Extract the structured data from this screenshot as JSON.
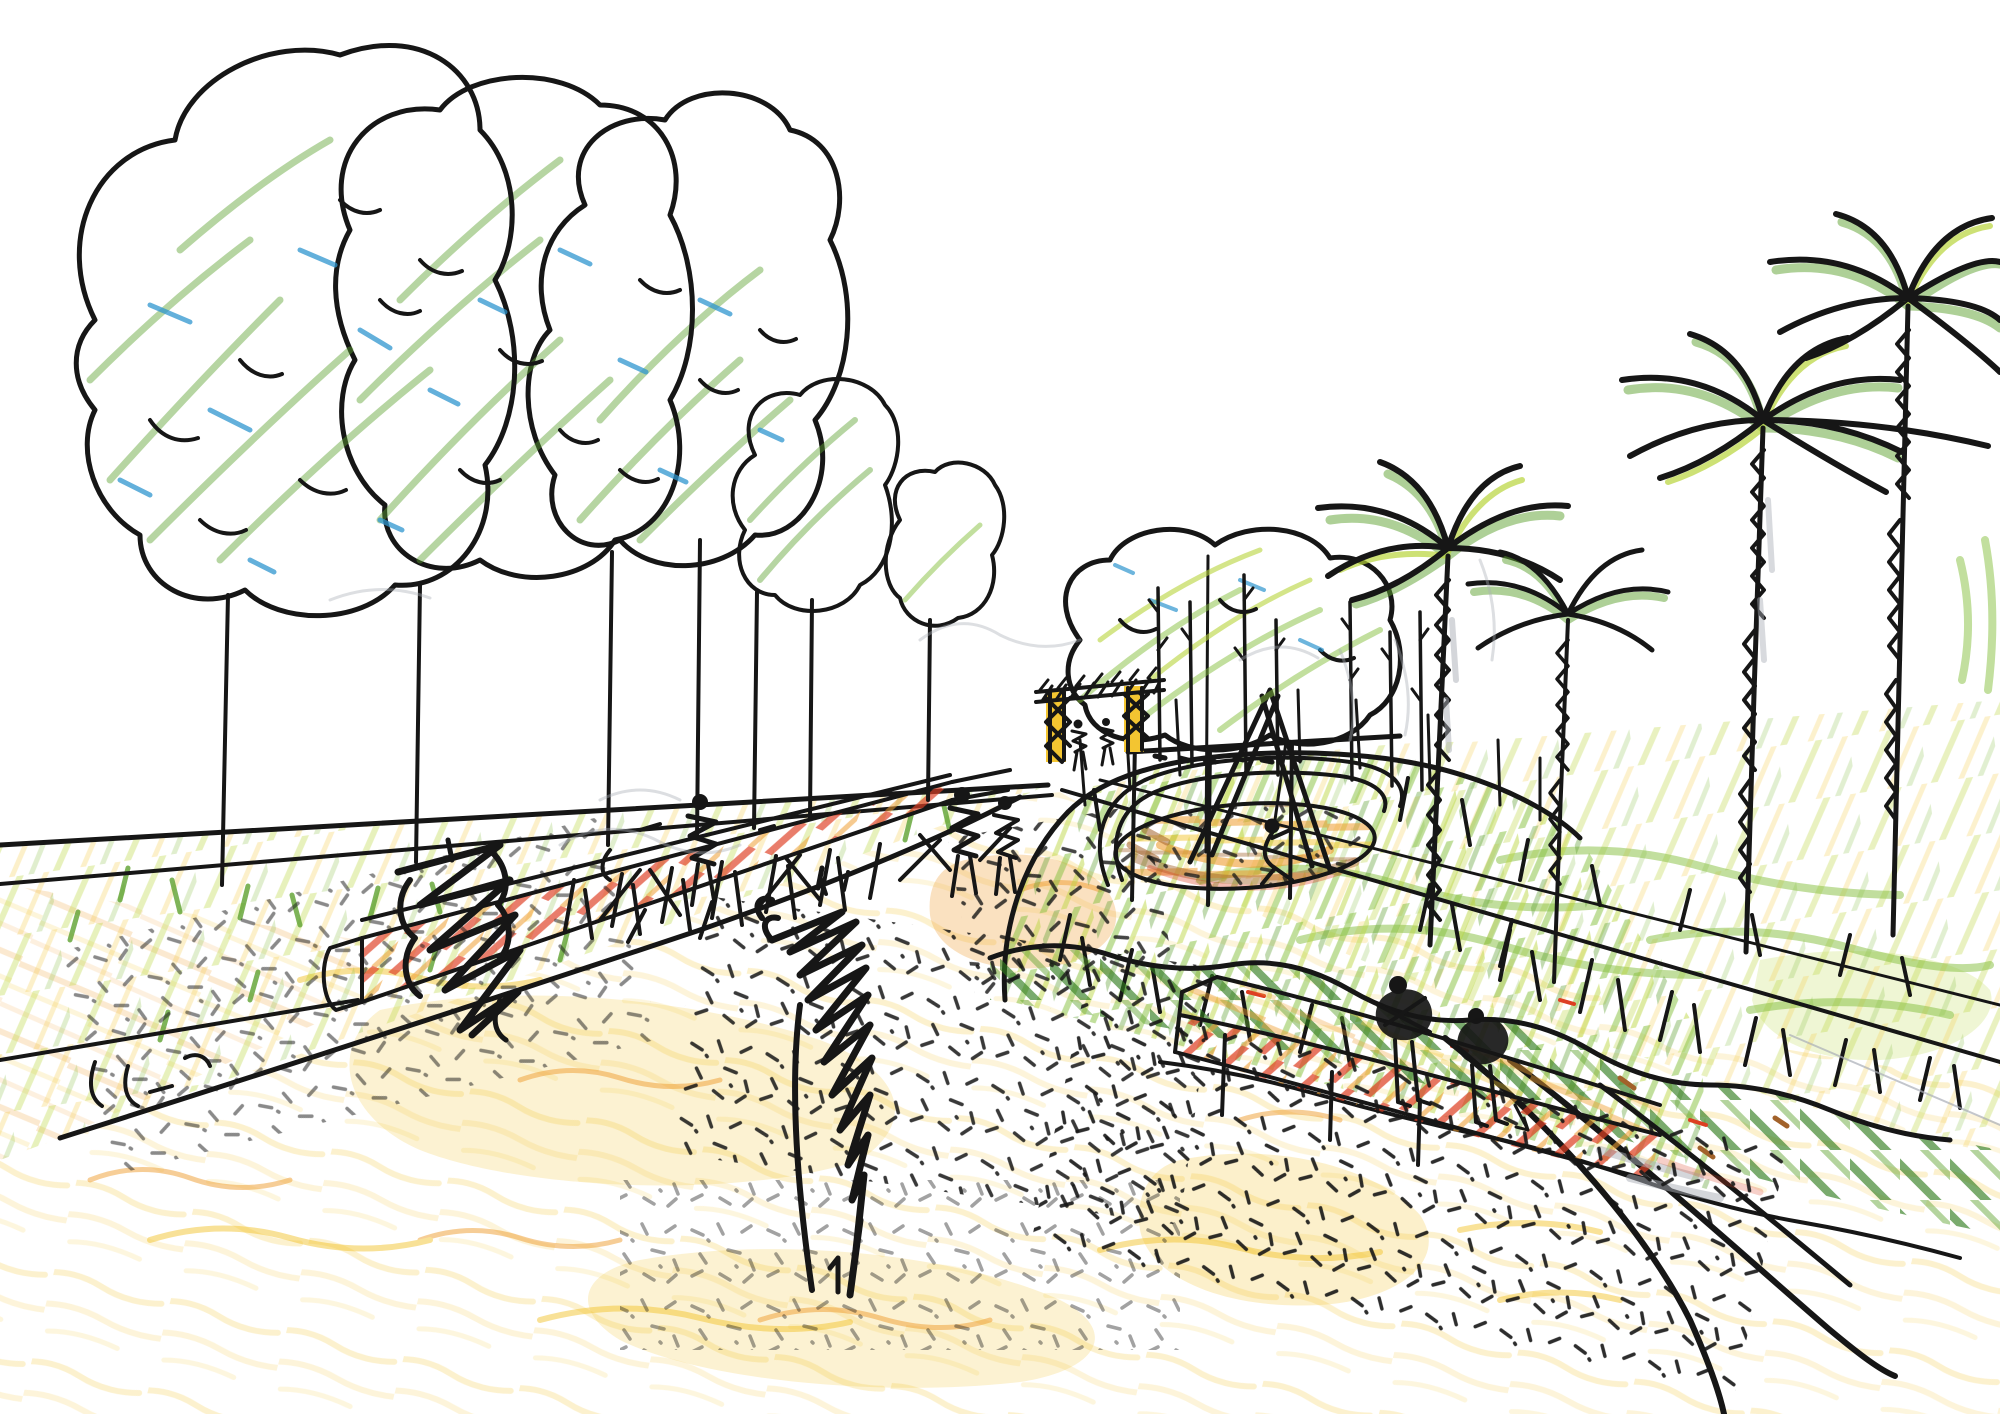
{
  "meta": {
    "title": "Hand-drawn landscape design perspective sketch",
    "medium": "black ink pen with colored pencil and crayon on white paper",
    "view": "one-point perspective of a park promenade"
  },
  "palette": {
    "paper": "#ffffff",
    "ink": "#161616",
    "green": "#5ea130",
    "green-light": "#85bf3e",
    "green-dark": "#2f7a1c",
    "yellow-green": "#b8d43a",
    "yellow": "#f3c531",
    "yellow-pale": "#f9e49a",
    "orange": "#ef9d30",
    "red": "#dd3f22",
    "brown": "#a2622b",
    "blue": "#2f96cf",
    "gray": "#a9aeb6"
  },
  "scene": {
    "elements": [
      {
        "name": "deciduous-tree-group-left",
        "description": "Four overlapping cloud-shaped canopies outlined in ink, filled with diagonal green crayon scribble and blue accents, thin bare trunks"
      },
      {
        "name": "small-tree-far",
        "description": "Tiny fifth canopy at the right end of the left tree row"
      },
      {
        "name": "center-tree-cluster",
        "description": "Wavy low canopy band behind the gate with yellow-green scribble, slender trunks and a dotted base line"
      },
      {
        "name": "entry-gate",
        "description": "Yellow gate posts with black cross bracing and a hatched double top beam, two small figures passing beneath"
      },
      {
        "name": "palm-trees",
        "description": "Four palms with arcing ink fronds shaded green and chevron-hatched trunks",
        "count": 4
      },
      {
        "name": "sapling-stems",
        "description": "Row of thin vertical stems with small branch ticks behind the planting island"
      },
      {
        "name": "left-meadow",
        "description": "Grass verge with yellow-green crayon and dark grass tufts between two long fence lines and the bank edge"
      },
      {
        "name": "left-bench-wall",
        "description": "Long low seat wall receding toward the gate, orange and red hatched face with a squared end cap"
      },
      {
        "name": "dark-shrub-scribble",
        "description": "Dense black zig-zag shrub drawn over the left wall"
      },
      {
        "name": "planting-island",
        "description": "Teardrop planting island with bright green scribble and grass tufts"
      },
      {
        "name": "sand-pit",
        "description": "Oval play sand area shaded orange and brown with black stipple and a double edging line"
      },
      {
        "name": "swing-set",
        "description": "A-frame swing with top bar and a swinging child figure"
      },
      {
        "name": "island-bench",
        "description": "Curved seat wall on the island, orange top and red hatched face, two seated scribble figures"
      },
      {
        "name": "hedge-band",
        "description": "Scalloped hedge band with dark green diagonal hatching and small red-brown accents"
      },
      {
        "name": "right-grass-slope",
        "description": "Rising meadow on the right with green squiggles and tufts"
      },
      {
        "name": "path-network",
        "description": "Converging ink path edges, bank line and sweeping curves to the lower right"
      },
      {
        "name": "ground-stipple",
        "description": "Black comma stipple over warm yellow crayon gravel"
      },
      {
        "name": "pedestrian-figures",
        "description": "Small scribbled walking figures on the path",
        "count": 3
      },
      {
        "name": "foreground-scribble-tree",
        "description": "Tall dark zig-zag scribble element in the center foreground"
      },
      {
        "name": "pencil-guide-swirls",
        "description": "Faint gray construction pencil arcs left from sketching"
      }
    ]
  }
}
